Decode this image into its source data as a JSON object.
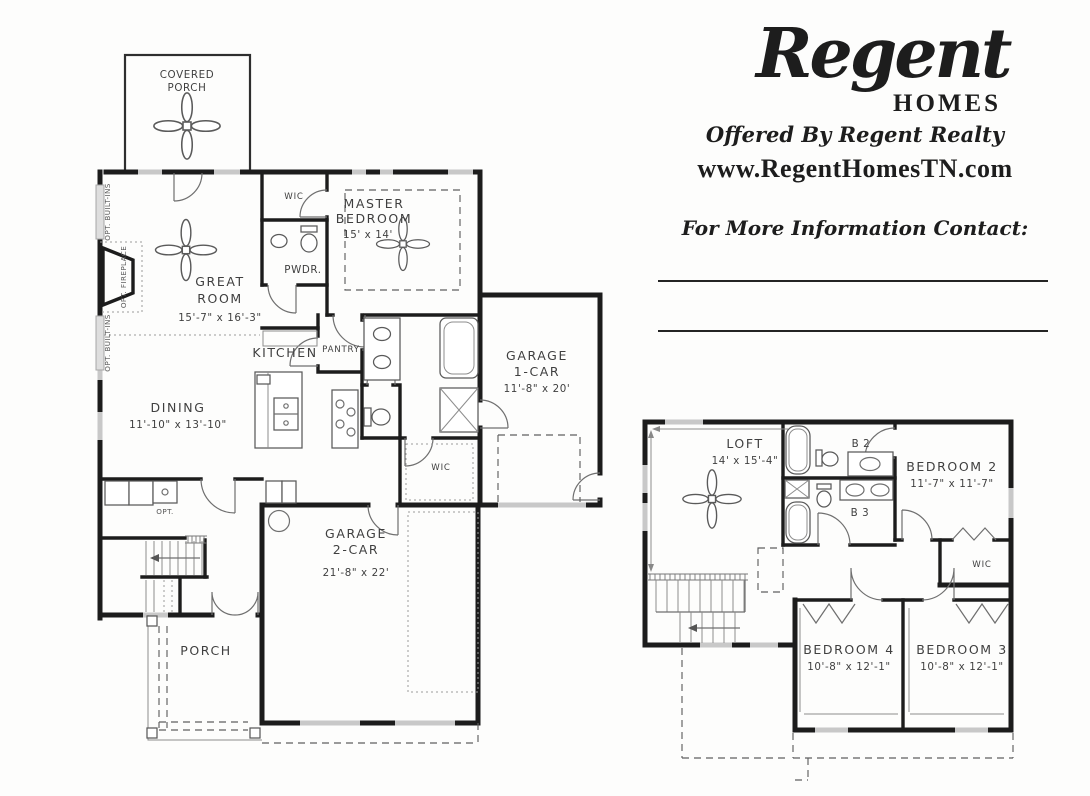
{
  "branding": {
    "logo_script": "Regent",
    "logo_homes": "HOMES",
    "offered_by": "Offered By Regent Realty",
    "website": "www.RegentHomesTN.com",
    "contact_heading": "For More Information Contact:"
  },
  "first_floor": {
    "covered_porch_l1": "COVERED",
    "covered_porch_l2": "PORCH",
    "wic_master": "WIC",
    "master_l1": "MASTER",
    "master_l2": "BEDROOM",
    "master_dims": "15' x 14'",
    "pwdr": "PWDR.",
    "great_l1": "GREAT",
    "great_l2": "ROOM",
    "great_dims": "15'-7\" x 16'-3\"",
    "kitchen": "KITCHEN",
    "pantry": "PANTRY",
    "dining": "DINING",
    "dining_dims": "11'-10\" x 13'-10\"",
    "garage1_l1": "GARAGE",
    "garage1_l2": "1-CAR",
    "garage1_dims": "11'-8\" x 20'",
    "wic_hall": "WIC",
    "garage2_l1": "GARAGE",
    "garage2_l2": "2-CAR",
    "garage2_dims": "21'-8\" x 22'",
    "porch": "PORCH",
    "opt_sink": "OPT.",
    "opt_builtins_top": "OPT. BUILT-INS",
    "opt_fireplace": "OPT. FIREPLACE",
    "opt_builtins_bottom": "OPT. BUILT-INS"
  },
  "second_floor": {
    "loft": "LOFT",
    "loft_dims": "14' x 15'-4\"",
    "bath2": "B 2",
    "bedroom2": "BEDROOM 2",
    "bedroom2_dims": "11'-7\" x 11'-7\"",
    "bath3": "B 3",
    "wic": "WIC",
    "bedroom4": "BEDROOM 4",
    "bedroom4_dims": "10'-8\" x 12'-1\"",
    "bedroom3": "BEDROOM 3",
    "bedroom3_dims": "10'-8\" x 12'-1\""
  }
}
